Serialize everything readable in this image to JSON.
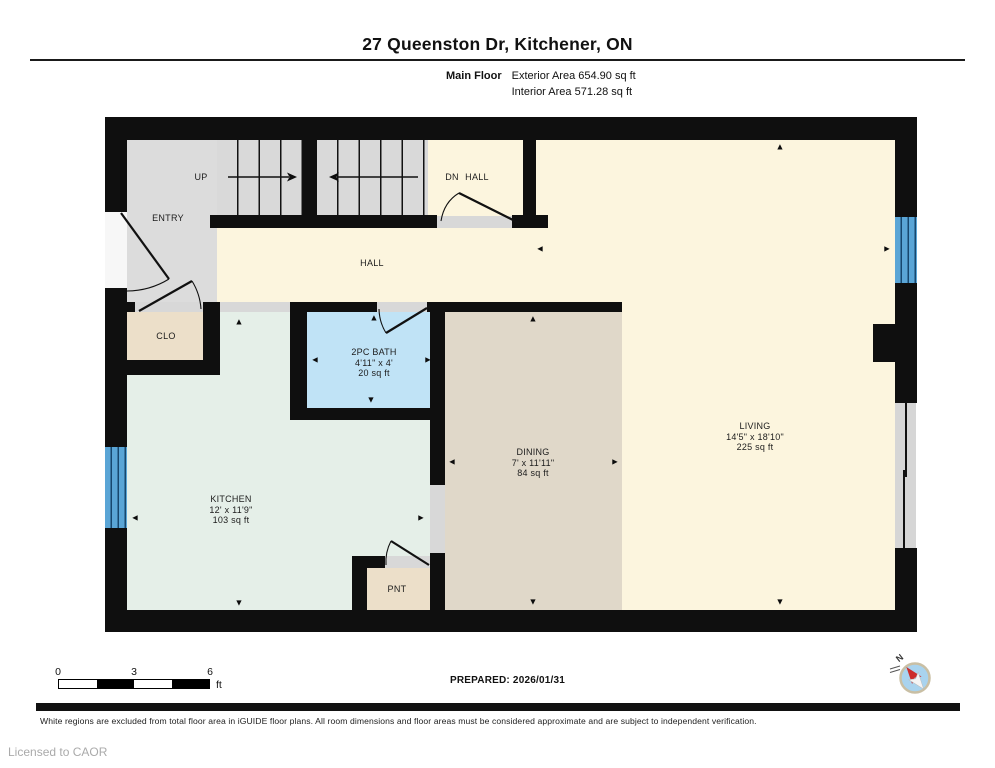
{
  "header": {
    "title": "27 Queenston Dr, Kitchener, ON",
    "floor_label": "Main Floor",
    "exterior_area": "Exterior Area 654.90 sq ft",
    "interior_area": "Interior Area 571.28 sq ft"
  },
  "rooms": {
    "living": {
      "name": "LIVING",
      "dims": "14'5\" x 18'10\"",
      "area": "225 sq ft"
    },
    "dining": {
      "name": "DINING",
      "dims": "7' x 11'11\"",
      "area": "84 sq ft"
    },
    "kitchen": {
      "name": "KITCHEN",
      "dims": "12' x 11'9\"",
      "area": "103 sq ft"
    },
    "bath": {
      "name": "2PC BATH",
      "dims": "4'11\" x 4'",
      "area": "20 sq ft"
    },
    "hall": {
      "name": "HALL"
    },
    "hall_upper": {
      "name": "HALL"
    },
    "entry": {
      "name": "ENTRY"
    },
    "closet": {
      "name": "CLO"
    },
    "pantry": {
      "name": "PNT"
    },
    "stairs_up": {
      "name": "UP"
    },
    "stairs_down": {
      "name": "DN"
    }
  },
  "icons": {
    "arrow_up": "▲",
    "arrow_down": "▼",
    "arrow_left": "◄",
    "arrow_right": "►",
    "compass_north": "N"
  },
  "scale_bar": {
    "tick_0": "0",
    "tick_3": "3",
    "tick_6": "6",
    "unit": "ft"
  },
  "footer": {
    "prepared": "PREPARED: 2026/01/31",
    "disclaimer": "White regions are excluded from total floor area in iGUIDE floor plans. All room dimensions and floor areas must be considered approximate and are subject to independent verification.",
    "license": "Licensed to CAOR"
  },
  "colors": {
    "wall": "#0f0f0f",
    "hall_cream": "#fcf5de",
    "entry_grey": "#dcdcdc",
    "kitchen_green": "#e5efe8",
    "dining_beige": "#e0d8c9",
    "closet_tan": "#ecdfc9",
    "bath_blue": "#c0e3f6",
    "window_blue": "#5aa5d6"
  }
}
